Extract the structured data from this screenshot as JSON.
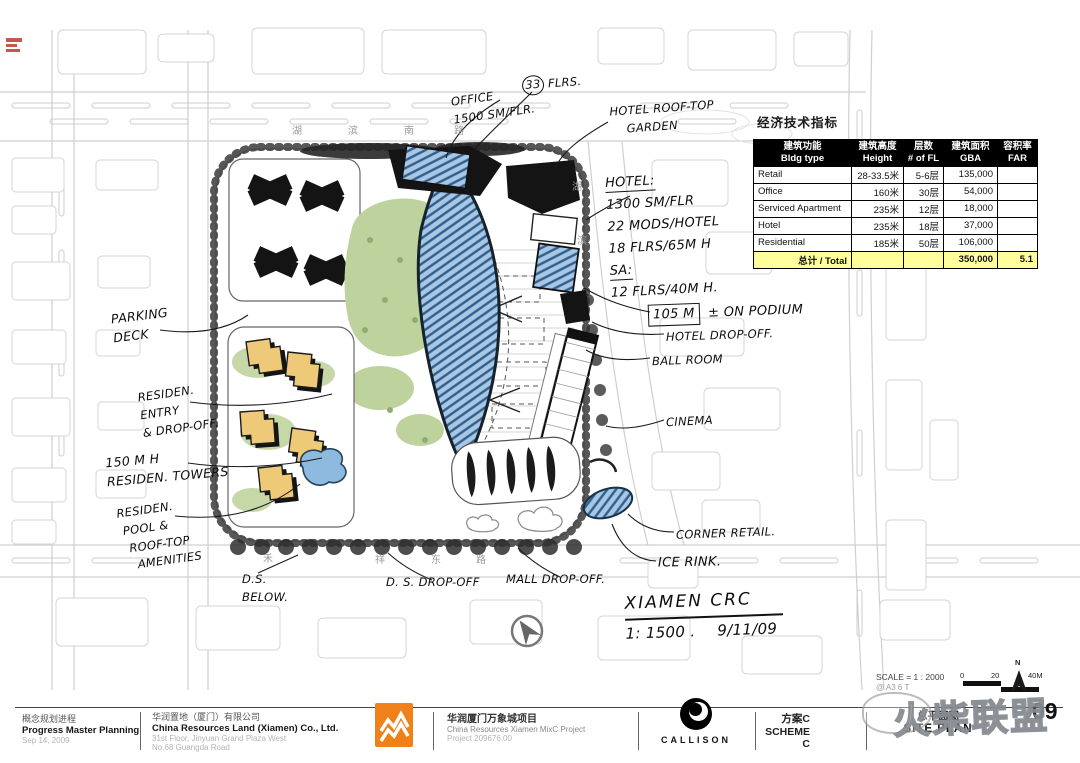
{
  "table": {
    "title": "经济技术指标",
    "headers": [
      {
        "cn": "建筑功能",
        "en": "Bldg type"
      },
      {
        "cn": "建筑高度",
        "en": "Height"
      },
      {
        "cn": "层数",
        "en": "# of FL"
      },
      {
        "cn": "建筑面积",
        "en": "GBA"
      },
      {
        "cn": "容积率",
        "en": "FAR"
      }
    ],
    "rows": [
      {
        "type": "Retail",
        "height": "28-33.5米",
        "fl": "5-6层",
        "gba": "135,000",
        "far": ""
      },
      {
        "type": "Office",
        "height": "160米",
        "fl": "30层",
        "gba": "54,000",
        "far": ""
      },
      {
        "type": "Serviced Apartment",
        "height": "235米",
        "fl": "12层",
        "gba": "18,000",
        "far": ""
      },
      {
        "type": "Hotel",
        "height": "235米",
        "fl": "18层",
        "gba": "37,000",
        "far": ""
      },
      {
        "type": "Residential",
        "height": "185米",
        "fl": "50层",
        "gba": "106,000",
        "far": ""
      }
    ],
    "total": {
      "label": "总计 / Total",
      "gba": "350,000",
      "far": "5.1"
    }
  },
  "plan": {
    "office": [
      "OFFICE",
      "1500 SM/FLR."
    ],
    "office_flrs": {
      "num": "33",
      "label": "FLRS."
    },
    "hotel_garden": [
      "HOTEL ROOF-TOP",
      "GARDEN"
    ],
    "hotel_notes": [
      "HOTEL:",
      "1300 SM/FLR",
      "22 MODS/HOTEL",
      "18 FLRS/65M H"
    ],
    "sa_notes": [
      "SA:",
      "12 FLRS/40M H."
    ],
    "podium": {
      "box": "105 M",
      "rest": "± ON PODIUM"
    },
    "hotel_dropoff": "HOTEL DROP-OFF.",
    "ballroom": "BALL ROOM",
    "cinema": "CINEMA",
    "corner_retail": "CORNER RETAIL.",
    "ice_rink": "ICE RINK.",
    "signature": {
      "line1": "XIAMEN CRC",
      "scale": "1: 1500 .",
      "date": "9/11/09"
    },
    "parking": [
      "PARKING",
      "DECK"
    ],
    "res_entry": [
      "RESIDEN.",
      "ENTRY",
      "& DROP-OFF."
    ],
    "res_towers": [
      "150 M H",
      "RESIDEN. TOWERS"
    ],
    "res_pool": [
      "RESIDEN.",
      "POOL &",
      "ROOF-TOP",
      "AMENITIES"
    ],
    "ds_below": [
      "D.S.",
      "BELOW."
    ],
    "ds_dropoff": "D. S. DROP-OFF",
    "mall_dropoff": "MALL DROP-OFF.",
    "roads": {
      "top": [
        "湖",
        "滨",
        "南",
        "路"
      ],
      "right": [
        "湖",
        "滨"
      ],
      "bottom": [
        "禾",
        "祥",
        "东",
        "路"
      ]
    }
  },
  "titleblock": {
    "col1": {
      "cn": "概念规划进程",
      "en": "Progress Master Planning",
      "date": "Sep 14, 2009"
    },
    "col2": {
      "cn": "华润置地（厦门）有限公司",
      "en": "China Resources Land (Xiamen) Co., Ltd.",
      "addr1": "31st Floor, Jinyuan Grand Plaza West",
      "addr2": "No.68 Guangda Road"
    },
    "col3": {
      "cn": "华润厦门万象城项目",
      "en": "China Resources Xiamen MixC Project",
      "project": "Project 209676.00"
    },
    "callison": "CALLISON",
    "scheme_cn": "方案C",
    "scheme_en": "SCHEME C",
    "sheet_cn": "总平面图",
    "sheet_en": "SITE PLAN",
    "page": "09",
    "scale_line1": "SCALE = 1 : 2000",
    "scale_line2": "@ A3 6 T",
    "ticks": [
      "0",
      "20",
      "40M"
    ],
    "north": "N"
  },
  "watermark": "火柴联盟",
  "colors": {
    "accent_orange": "#f08018",
    "table_total_yellow": "#ffff9c",
    "glass_blue": "#a9c7e2",
    "landscape_green": "#bdd29c",
    "tower_yellow": "#edc978"
  }
}
